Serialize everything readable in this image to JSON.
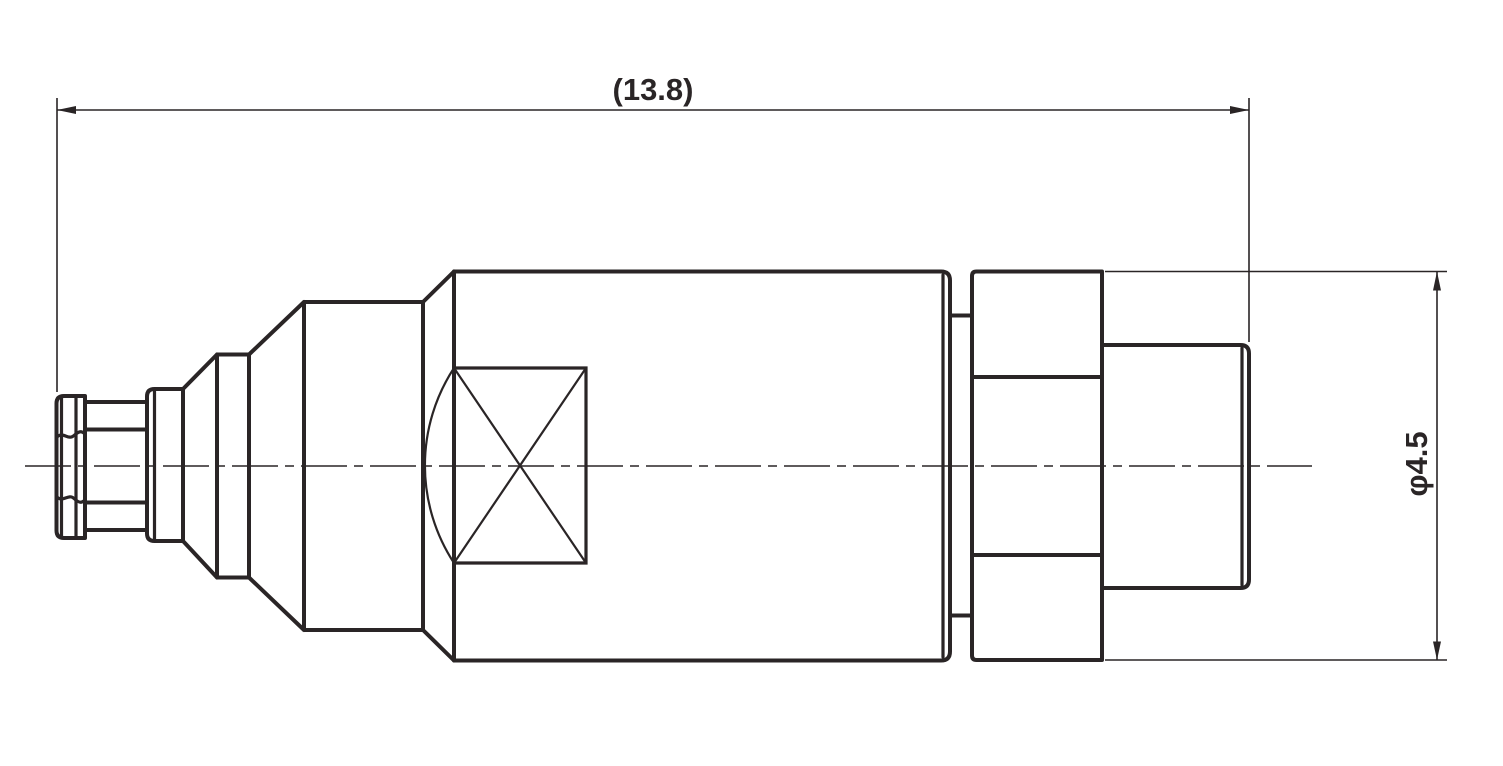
{
  "page": {
    "background": "#ffffff"
  },
  "drawing": {
    "type": "engineering-side-view-connector",
    "line_color": "#2a2526",
    "dimensions": {
      "length": {
        "label": "(13.8)",
        "value": 13.8
      },
      "diameter": {
        "label": "φ4.5",
        "value": 4.5
      }
    }
  }
}
